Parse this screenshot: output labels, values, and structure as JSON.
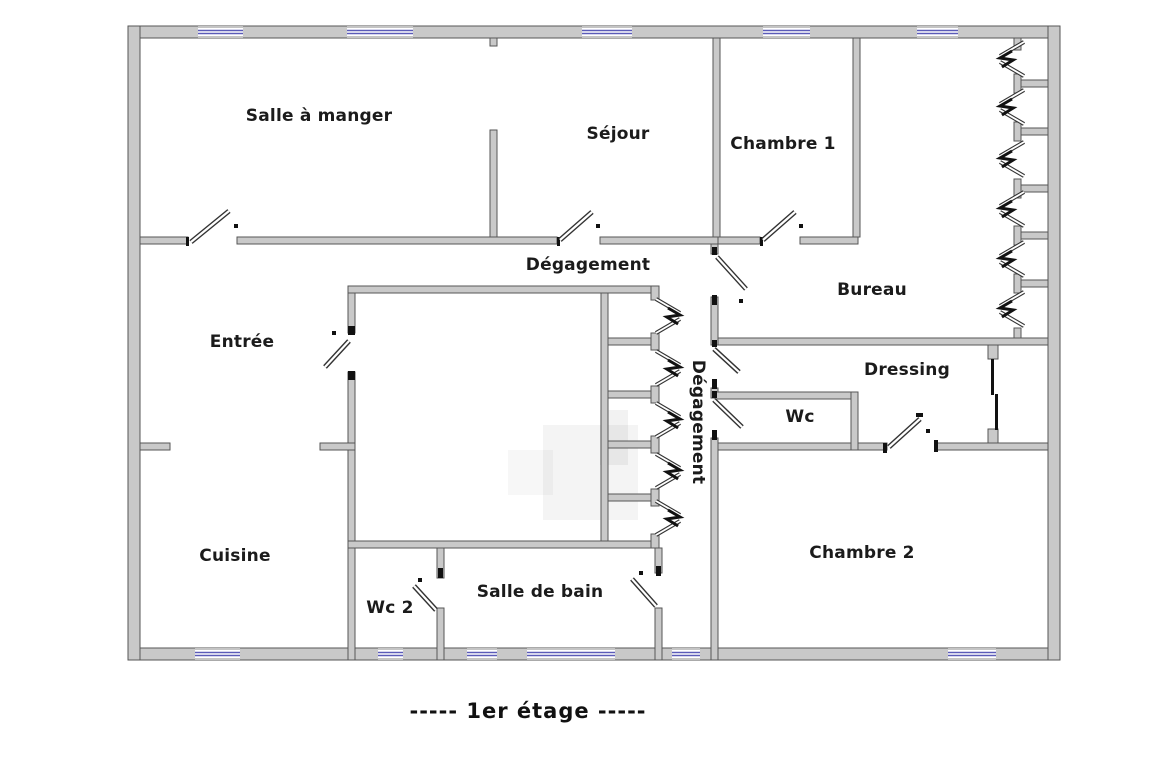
{
  "meta": {
    "caption": "-----  1er étage  -----",
    "caption_pos": [
      528,
      711
    ]
  },
  "colors": {
    "background": "#ffffff",
    "wall_fill": "#c9c9c9",
    "wall_stroke": "#565656",
    "window_glass": "#5b5bb8",
    "window_edge": "#8a8a8a",
    "door_outline": "#333333",
    "door_fill": "#ffffff",
    "jamb_black": "#111111",
    "label_color": "#1b1b1b",
    "watermark": "#000000"
  },
  "rooms": [
    {
      "id": "salle-a-manger",
      "label": "Salle à manger",
      "x": 319,
      "y": 116,
      "rotated": false
    },
    {
      "id": "sejour",
      "label": "Séjour",
      "x": 618,
      "y": 134,
      "rotated": false
    },
    {
      "id": "chambre-1",
      "label": "Chambre 1",
      "x": 783,
      "y": 144,
      "rotated": false
    },
    {
      "id": "degagement-h",
      "label": "Dégagement",
      "x": 588,
      "y": 265,
      "rotated": false
    },
    {
      "id": "bureau",
      "label": "Bureau",
      "x": 872,
      "y": 290,
      "rotated": false
    },
    {
      "id": "entree",
      "label": "Entrée",
      "x": 242,
      "y": 342,
      "rotated": false
    },
    {
      "id": "dressing",
      "label": "Dressing",
      "x": 907,
      "y": 370,
      "rotated": false
    },
    {
      "id": "wc",
      "label": "Wc",
      "x": 800,
      "y": 417,
      "rotated": false
    },
    {
      "id": "degagement-v",
      "label": "Dégagement",
      "x": 698,
      "y": 422,
      "rotated": true
    },
    {
      "id": "chambre-2",
      "label": "Chambre 2",
      "x": 862,
      "y": 553,
      "rotated": false
    },
    {
      "id": "cuisine",
      "label": "Cuisine",
      "x": 235,
      "y": 556,
      "rotated": false
    },
    {
      "id": "wc-2",
      "label": "Wc 2",
      "x": 390,
      "y": 608,
      "rotated": false
    },
    {
      "id": "salle-de-bain",
      "label": "Salle de bain",
      "x": 540,
      "y": 592,
      "rotated": false
    }
  ],
  "plan": {
    "size": [
      1164,
      759
    ],
    "walls": [
      [
        128,
        26,
        932,
        12
      ],
      [
        128,
        648,
        932,
        12
      ],
      [
        128,
        26,
        12,
        634
      ],
      [
        1048,
        26,
        12,
        634
      ],
      [
        140,
        237,
        48,
        7
      ],
      [
        237,
        237,
        320,
        7
      ],
      [
        600,
        237,
        118,
        7
      ],
      [
        718,
        237,
        42,
        7
      ],
      [
        800,
        237,
        58,
        7
      ],
      [
        490,
        130,
        7,
        107
      ],
      [
        713,
        38,
        7,
        199
      ],
      [
        853,
        38,
        7,
        199
      ],
      [
        490,
        38,
        7,
        8
      ],
      [
        348,
        286,
        310,
        7
      ],
      [
        348,
        293,
        7,
        40
      ],
      [
        348,
        372,
        7,
        288
      ],
      [
        348,
        541,
        310,
        7
      ],
      [
        601,
        293,
        7,
        248
      ],
      [
        608,
        338,
        43,
        7
      ],
      [
        608,
        391,
        43,
        7
      ],
      [
        608,
        441,
        43,
        7
      ],
      [
        608,
        494,
        43,
        7
      ],
      [
        651,
        333,
        8,
        17
      ],
      [
        651,
        386,
        8,
        17
      ],
      [
        651,
        436,
        8,
        17
      ],
      [
        651,
        489,
        8,
        17
      ],
      [
        651,
        286,
        8,
        14
      ],
      [
        651,
        534,
        8,
        14
      ],
      [
        711,
        244,
        7,
        10
      ],
      [
        711,
        297,
        7,
        48
      ],
      [
        711,
        388,
        7,
        10
      ],
      [
        711,
        438,
        7,
        222
      ],
      [
        718,
        338,
        330,
        7
      ],
      [
        988,
        345,
        10,
        14
      ],
      [
        988,
        429,
        10,
        14
      ],
      [
        718,
        443,
        169,
        7
      ],
      [
        935,
        443,
        113,
        7
      ],
      [
        715,
        392,
        143,
        7
      ],
      [
        851,
        392,
        7,
        58
      ],
      [
        437,
        548,
        7,
        30
      ],
      [
        437,
        608,
        7,
        52
      ],
      [
        655,
        548,
        7,
        25
      ],
      [
        655,
        608,
        7,
        52
      ],
      [
        140,
        443,
        30,
        7
      ],
      [
        320,
        443,
        35,
        7
      ],
      [
        1014,
        80,
        34,
        7
      ],
      [
        1014,
        128,
        34,
        7
      ],
      [
        1014,
        185,
        34,
        7
      ],
      [
        1014,
        232,
        34,
        7
      ],
      [
        1014,
        280,
        34,
        7
      ],
      [
        1014,
        74,
        7,
        19
      ],
      [
        1014,
        122,
        7,
        19
      ],
      [
        1014,
        179,
        7,
        19
      ],
      [
        1014,
        226,
        7,
        19
      ],
      [
        1014,
        274,
        7,
        19
      ],
      [
        1014,
        38,
        7,
        12
      ],
      [
        1014,
        328,
        7,
        10
      ]
    ],
    "windows": [
      {
        "x": 198,
        "y": 26,
        "w": 45,
        "h": 12
      },
      {
        "x": 347,
        "y": 26,
        "w": 66,
        "h": 12
      },
      {
        "x": 582,
        "y": 26,
        "w": 50,
        "h": 12
      },
      {
        "x": 763,
        "y": 26,
        "w": 47,
        "h": 12
      },
      {
        "x": 917,
        "y": 26,
        "w": 41,
        "h": 12
      },
      {
        "x": 195,
        "y": 648,
        "w": 45,
        "h": 12
      },
      {
        "x": 378,
        "y": 648,
        "w": 25,
        "h": 12
      },
      {
        "x": 467,
        "y": 648,
        "w": 30,
        "h": 12
      },
      {
        "x": 527,
        "y": 648,
        "w": 88,
        "h": 12
      },
      {
        "x": 672,
        "y": 648,
        "w": 28,
        "h": 12
      },
      {
        "x": 948,
        "y": 648,
        "w": 48,
        "h": 12
      }
    ],
    "sliding_panels": [
      [
        991,
        359,
        3,
        36
      ],
      [
        995,
        394,
        3,
        36
      ]
    ],
    "jambs": [
      [
        186,
        237,
        3,
        9
      ],
      [
        557,
        237,
        3,
        9
      ],
      [
        760,
        237,
        3,
        9
      ],
      [
        712,
        247,
        5,
        8
      ],
      [
        712,
        295,
        5,
        10
      ],
      [
        712,
        340,
        5,
        7
      ],
      [
        712,
        379,
        5,
        10
      ],
      [
        712,
        391,
        5,
        7
      ],
      [
        712,
        430,
        5,
        10
      ],
      [
        656,
        566,
        5,
        10
      ],
      [
        438,
        568,
        5,
        10
      ],
      [
        883,
        443,
        4,
        10
      ],
      [
        916,
        413,
        7,
        4
      ],
      [
        934,
        440,
        4,
        12
      ],
      [
        348,
        326,
        7,
        9
      ],
      [
        348,
        371,
        7,
        9
      ]
    ],
    "doors": [
      {
        "leaf": [
          191,
          242,
          229,
          211
        ],
        "dot": [
          236,
          226
        ]
      },
      {
        "leaf": [
          560,
          240,
          592,
          212
        ],
        "dot": [
          598,
          226
        ]
      },
      {
        "leaf": [
          763,
          240,
          795,
          212
        ],
        "dot": [
          801,
          226
        ]
      },
      {
        "leaf": [
          717,
          257,
          746,
          289
        ],
        "dot": [
          741,
          301
        ]
      },
      {
        "leaf": [
          714,
          349,
          739,
          372
        ],
        "dot": null
      },
      {
        "leaf": [
          714,
          400,
          742,
          427
        ],
        "dot": null
      },
      {
        "leaf": [
          632,
          579,
          656,
          606
        ],
        "dot": [
          641,
          573
        ]
      },
      {
        "leaf": [
          414,
          586,
          436,
          610
        ],
        "dot": [
          420,
          580
        ]
      },
      {
        "leaf": [
          889,
          447,
          920,
          419
        ],
        "dot": [
          928,
          431
        ]
      },
      {
        "leaf": [
          325,
          367,
          349,
          341
        ],
        "dot": [
          334,
          333
        ]
      }
    ],
    "bifold_doors": [
      {
        "px": 1000,
        "ox": 1024,
        "cy": 59
      },
      {
        "px": 1000,
        "ox": 1024,
        "cy": 107
      },
      {
        "px": 1000,
        "ox": 1024,
        "cy": 159
      },
      {
        "px": 1000,
        "ox": 1024,
        "cy": 209
      },
      {
        "px": 1000,
        "ox": 1024,
        "cy": 259
      },
      {
        "px": 1000,
        "ox": 1024,
        "cy": 309
      },
      {
        "px": 680,
        "ox": 656,
        "cy": 316
      },
      {
        "px": 680,
        "ox": 656,
        "cy": 368
      },
      {
        "px": 680,
        "ox": 656,
        "cy": 420
      },
      {
        "px": 680,
        "ox": 656,
        "cy": 471
      },
      {
        "px": 680,
        "ox": 656,
        "cy": 518
      }
    ],
    "watermark_rects": [
      {
        "r": [
          543,
          425,
          95,
          95
        ],
        "o": 0.045
      },
      {
        "r": [
          508,
          450,
          45,
          45
        ],
        "o": 0.03
      },
      {
        "r": [
          600,
          410,
          28,
          55
        ],
        "o": 0.05
      }
    ]
  }
}
